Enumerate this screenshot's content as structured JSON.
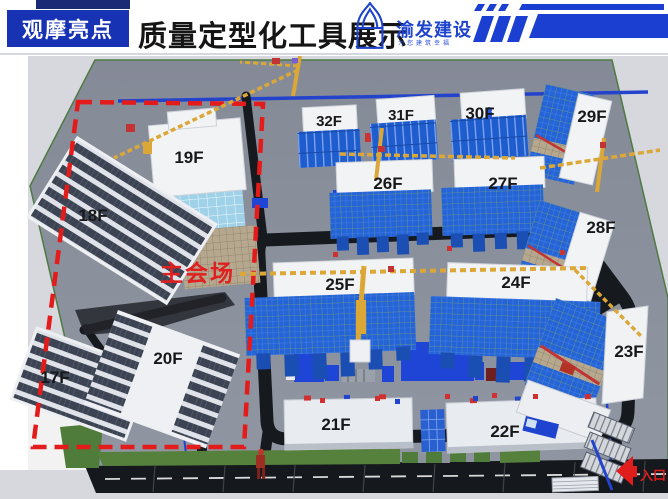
{
  "header": {
    "badge_label": "观摩亮点",
    "title": "质量定型化工具展示",
    "logo": {
      "company": "渝发建设",
      "slogan": "为您建筑幸福"
    }
  },
  "site_plan": {
    "annotations": {
      "main_venue": "主会场",
      "entrance": "入口"
    },
    "buildings": [
      {
        "id": "b32",
        "label": "32F"
      },
      {
        "id": "b31",
        "label": "31F"
      },
      {
        "id": "b30",
        "label": "30F"
      },
      {
        "id": "b29",
        "label": "29F"
      },
      {
        "id": "b26",
        "label": "26F"
      },
      {
        "id": "b27",
        "label": "27F"
      },
      {
        "id": "b28",
        "label": "28F"
      },
      {
        "id": "b19",
        "label": "19F"
      },
      {
        "id": "b18",
        "label": "18F"
      },
      {
        "id": "b25",
        "label": "25F"
      },
      {
        "id": "b24",
        "label": "24F"
      },
      {
        "id": "b17",
        "label": "17F"
      },
      {
        "id": "b20",
        "label": "20F"
      },
      {
        "id": "b23",
        "label": "23F"
      },
      {
        "id": "b21",
        "label": "21F"
      },
      {
        "id": "b22",
        "label": "22F"
      }
    ],
    "colors": {
      "scaffold_blue": "#2464d6",
      "accent_blue": "#1e43cc",
      "ground_gray": "#878c99",
      "highlight_red": "#e41b1b",
      "crane_yellow": "#dba838"
    }
  }
}
